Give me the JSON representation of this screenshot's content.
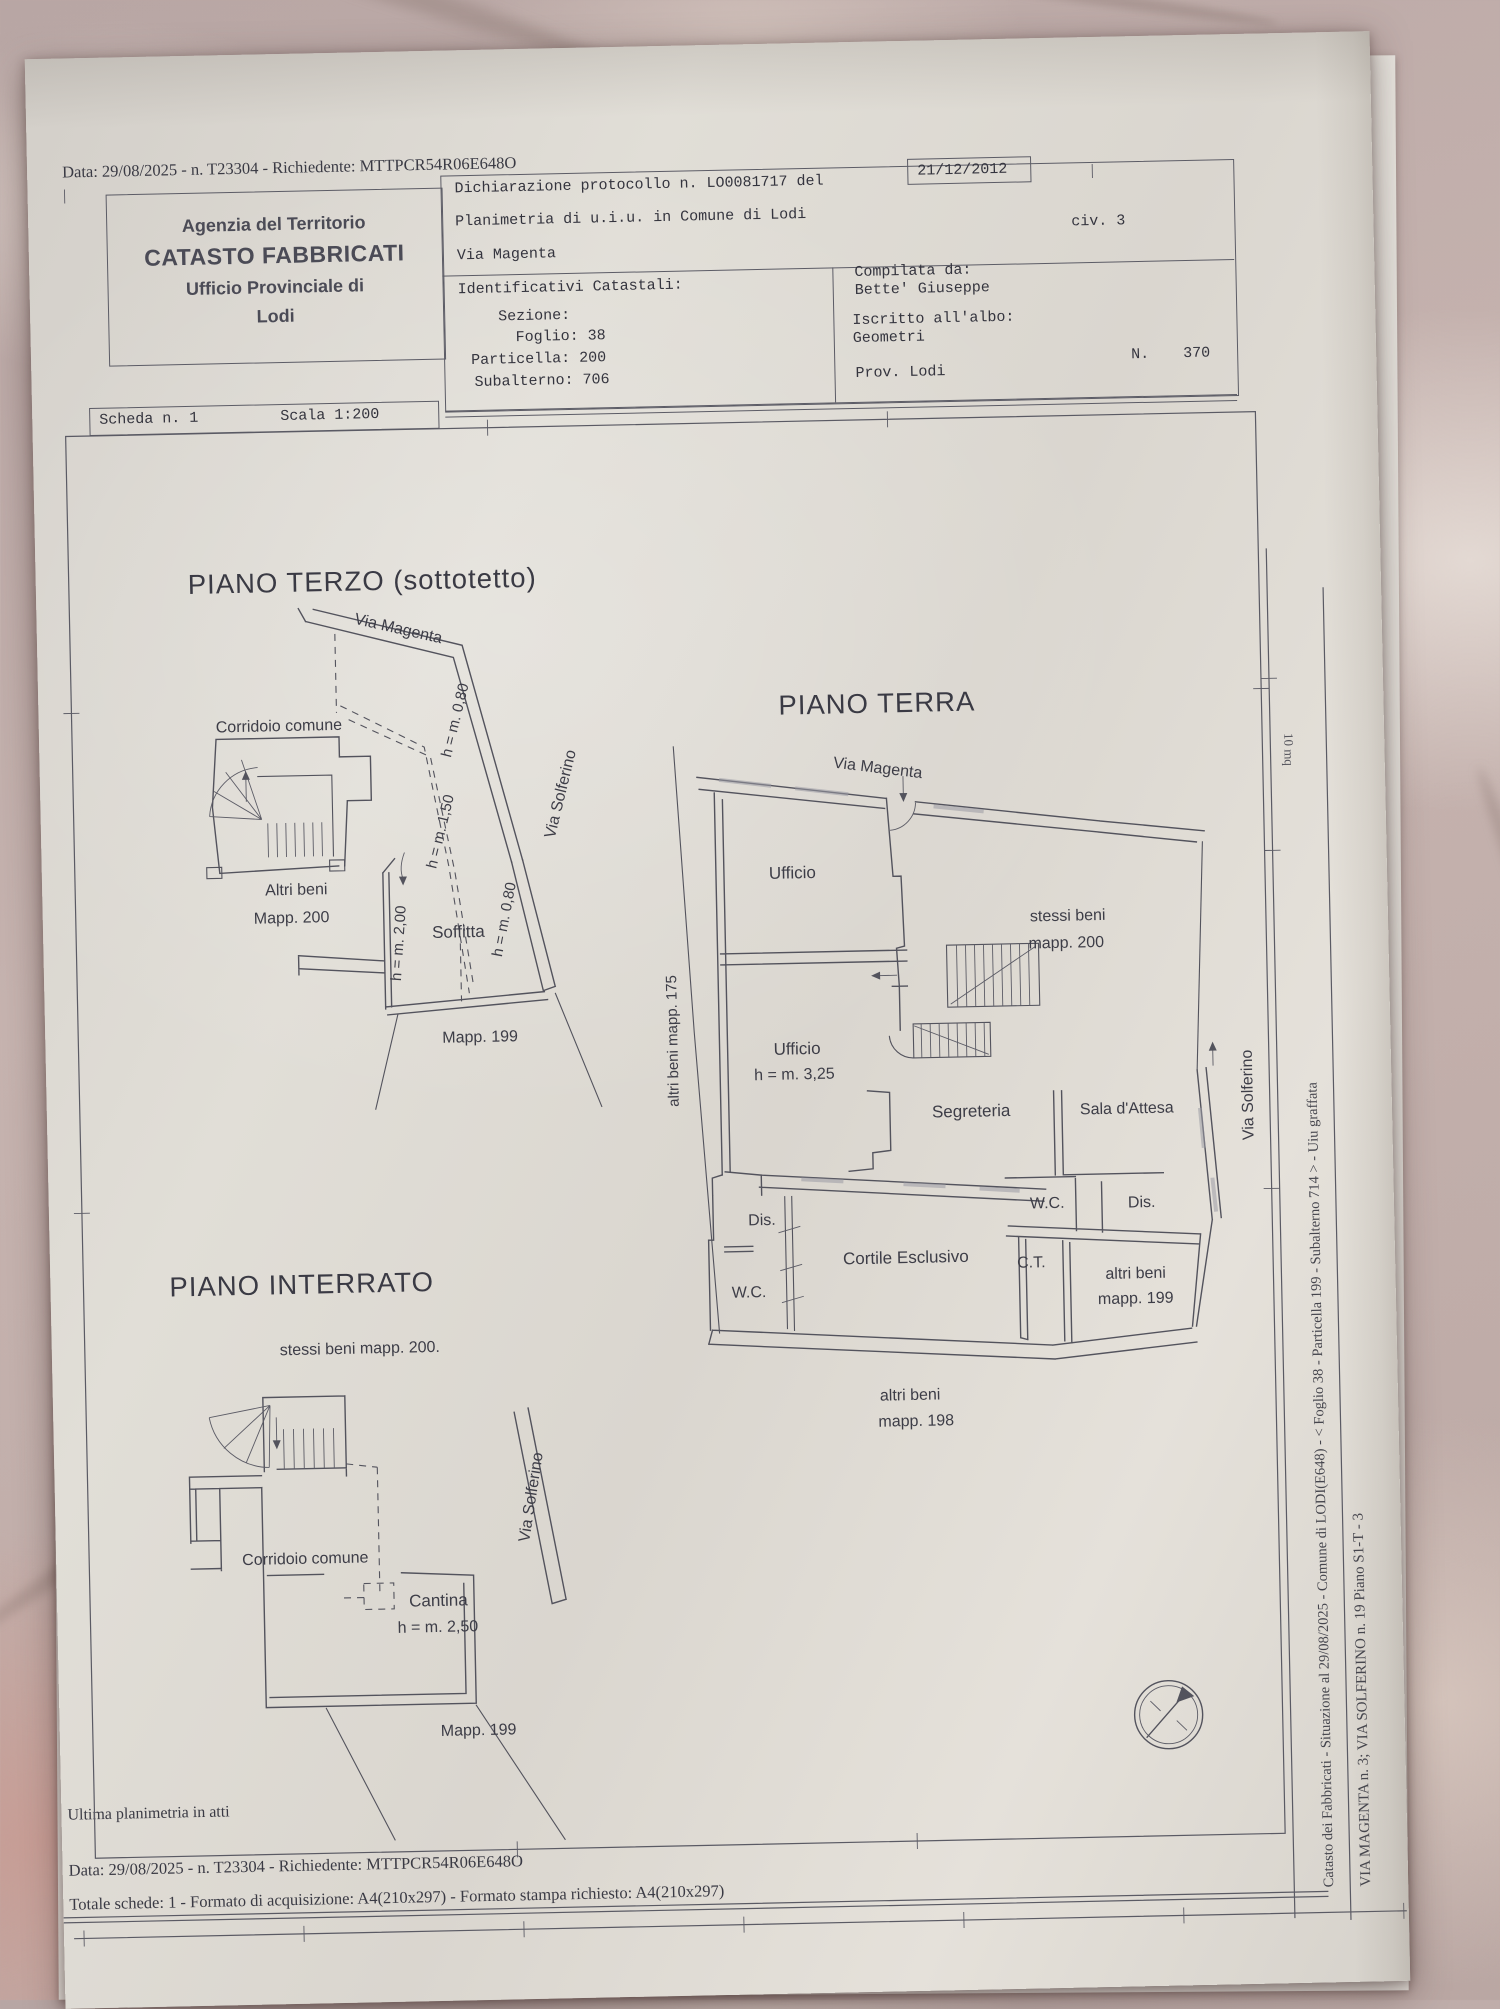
{
  "colors": {
    "marble": "#bdaaa8",
    "paper": "#ded9d2",
    "ink": "#3c3c46",
    "plan_line": "#53535d"
  },
  "top_line": "Data: 29/08/2025 - n. T23304 - Richiedente: MTTPCR54R06E648O",
  "header": {
    "agency_line1": "Agenzia del Territorio",
    "agency_line2": "CATASTO FABBRICATI",
    "agency_line3": "Ufficio Provinciale di",
    "agency_line4": "Lodi",
    "declaration": "Dichiarazione protocollo n. LO0081717 del",
    "declaration_date": "21/12/2012",
    "planimetria": "Planimetria di u.i.u. in Comune di Lodi",
    "street": "Via Magenta",
    "civ": "civ. 3",
    "identificativi": "Identificativi Catastali:",
    "sezione": "Sezione:",
    "foglio": "Foglio: 38",
    "particella": "Particella: 200",
    "subalterno": "Subalterno: 706",
    "compilata": "Compilata da:",
    "compilata_nome": "Bette' Giuseppe",
    "iscritto": "Iscritto all'albo:",
    "albo": "Geometri",
    "prov": "Prov. Lodi",
    "numero_label": "N.",
    "numero": "370",
    "scheda": "Scheda n. 1",
    "scala": "Scala 1:200"
  },
  "piano_terzo": {
    "title": "PIANO TERZO (sottotetto)",
    "via_magenta": "Via Magenta",
    "corridoio": "Corridoio comune",
    "h_080_a": "h = m. 0,80",
    "h_150": "h = m. 1,50",
    "via_solferino": "Via Solferino",
    "altri_beni": "Altri beni",
    "mapp_200": "Mapp. 200",
    "h_200": "h = m. 2,00",
    "soffitta": "Soffitta",
    "h_080_b": "h = m. 0,80",
    "mapp_199": "Mapp. 199"
  },
  "piano_terra": {
    "title": "PIANO TERRA",
    "via_magenta": "Via Magenta",
    "ufficio_1": "Ufficio",
    "stessi_beni": "stessi beni",
    "mapp_200": "mapp. 200",
    "altri_beni_175": "altri beni mapp. 175",
    "ufficio_2": "Ufficio",
    "h_325": "h = m. 3,25",
    "segreteria": "Segreteria",
    "sala_attesa": "Sala d'Attesa",
    "via_solferino": "Via Solferino",
    "dis_1": "Dis.",
    "wc_right": "W.C.",
    "dis_2": "Dis.",
    "cortile": "Cortile Esclusivo",
    "ct": "C.T.",
    "altri_beni_199": "altri beni",
    "mapp_199": "mapp. 199",
    "wc_left": "W.C.",
    "altri_beni_198": "altri beni",
    "mapp_198": "mapp. 198"
  },
  "piano_interrato": {
    "title": "PIANO INTERRATO",
    "stessi_beni": "stessi beni mapp. 200.",
    "corridoio": "Corridoio comune",
    "via_solferino": "Via Solferino",
    "cantina": "Cantina",
    "h_250": "h = m. 2,50",
    "mapp_199": "Mapp. 199"
  },
  "footer": {
    "ultima": "Ultima planimetria in atti",
    "data_line": "Data: 29/08/2025 - n. T23304 - Richiedente: MTTPCR54R06E648O",
    "totale_line": "Totale schede: 1 - Formato di acquisizione: A4(210x297)  - Formato stampa richiesto: A4(210x297)"
  },
  "side_text": {
    "catasto_line": "Catasto dei Fabbricati - Situazione al 29/08/2025 - Comune di LODI(E648) - <  Foglio 38 - Particella  199 - Subalterno 714 > - Uiu graffata",
    "indirizzo_line": "VIA MAGENTA n. 3; VIA SOLFERINO n. 19 Piano S1-T - 3",
    "mq_note": "10 mq"
  }
}
